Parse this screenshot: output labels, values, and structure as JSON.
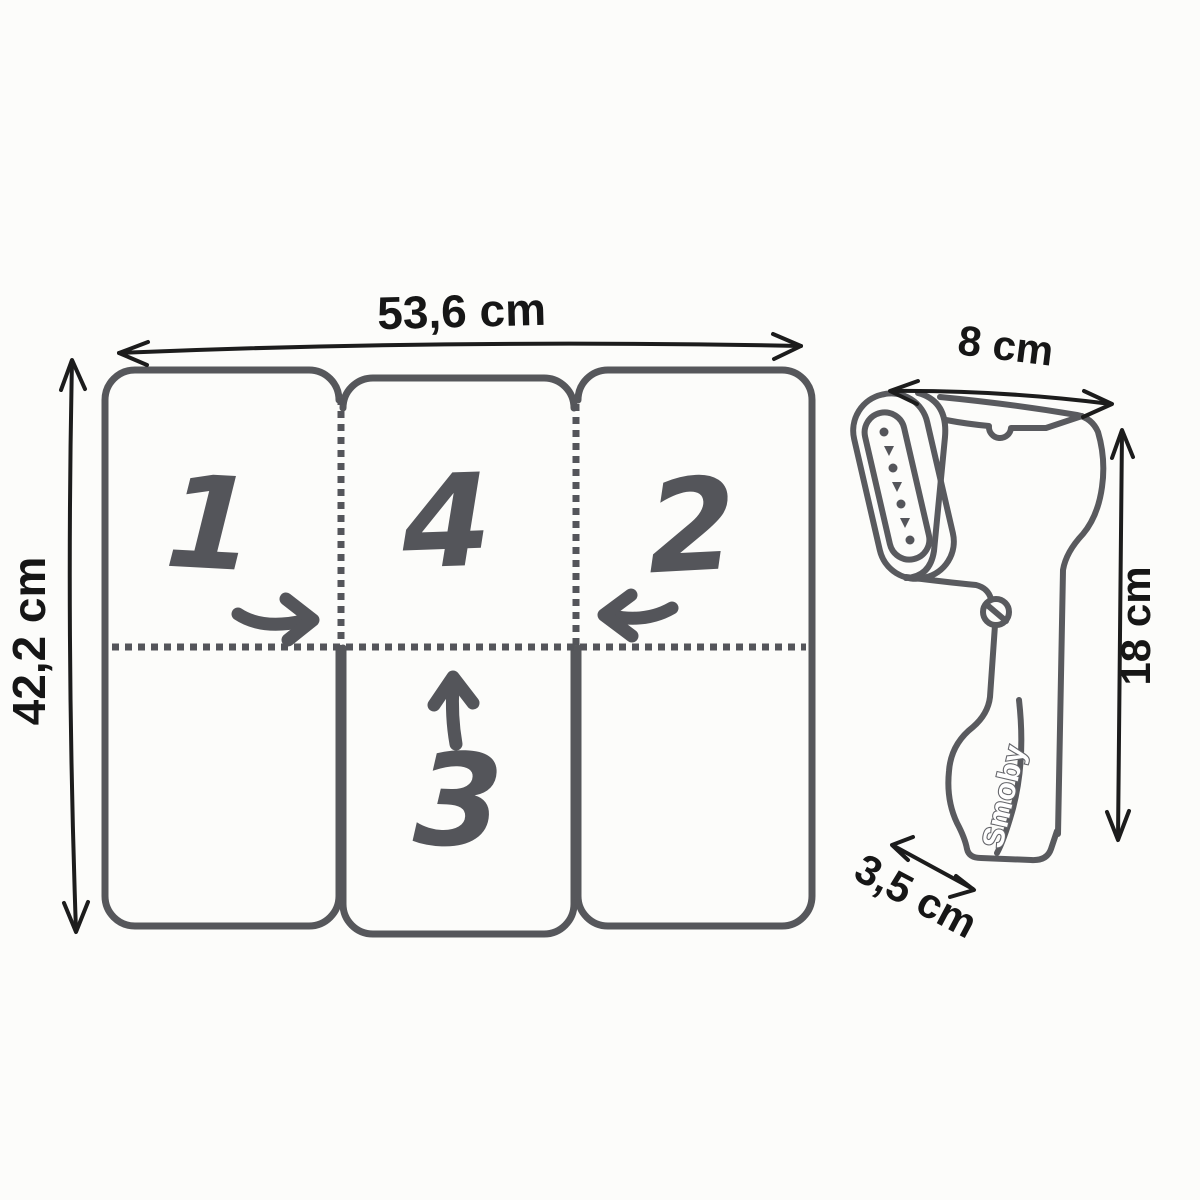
{
  "board": {
    "width_label": "53,6 cm",
    "height_label": "42,2 cm",
    "panels": {
      "p1": "1",
      "p4": "4",
      "p2": "2",
      "p3": "3"
    }
  },
  "steamer": {
    "brand_label": "Smoby",
    "head_width_label": "8 cm",
    "body_height_label": "18 cm",
    "base_depth_label": "3,5 cm"
  },
  "colors": {
    "sketch_gray": "#56575b",
    "dimension_black": "#1c1c1c",
    "background": "#fcfcfa",
    "brand_outline": "#65666b"
  }
}
